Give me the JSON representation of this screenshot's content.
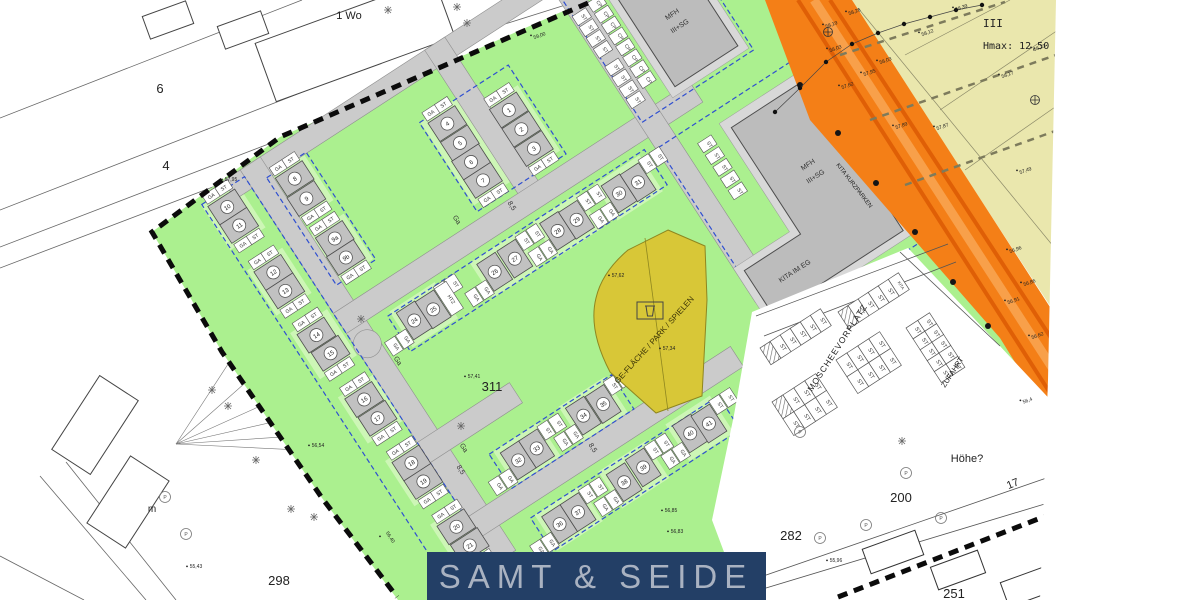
{
  "banner": {
    "title": "SAMT & SEIDE"
  },
  "zone": {
    "storeys": "III",
    "hmax": "Hmax: 12,50"
  },
  "labels": {
    "wo": "1 Wo",
    "m": "m",
    "hoehe": "Höhe?",
    "mfh": "MFH",
    "mfh_storeys": "III+SG",
    "kita_eg": "KITA IM EG",
    "kita_kurzparken": "KITA KURZPARKEN",
    "moscheevorplatz": "MOSCHEEVORPLATZ",
    "zufahrt": "ZUFAHRT",
    "ge_flaeche": "GE-FLÄCHE / PARK / SPIELEN",
    "tree_label": "P"
  },
  "parcels": {
    "p6": "6",
    "p4": "4",
    "p298": "298",
    "p311": "311",
    "p282": "282",
    "p200": "200",
    "p17": "17",
    "p251": "251"
  },
  "colors": {
    "green": "#abf08f",
    "pad": "#cdf6b6",
    "road": "#cbcbcb",
    "roadEdge": "#8f8f8f",
    "building": "#c1c1c1",
    "buildingEdge": "#4d4d4d",
    "beige": "#eae7ad",
    "orange": "#f47f17",
    "orangeDark": "#df5f06",
    "orangeLight": "#f8a04a",
    "yellow": "#d8c737",
    "yellowEdge": "#8e861f",
    "blue": "#2f4fd0",
    "navy": "#233f66",
    "bannerText": "#a9b2c1",
    "boundary": "#0b0b0b"
  },
  "estate": {
    "origin": [
      420,
      300
    ],
    "rotation": -33,
    "cell_labels": {
      "ga": "GA",
      "st": "ST",
      "cp": "CP",
      "htz": "HTZ"
    },
    "streets": [
      [
        -100,
        -207,
        280,
        -185
      ],
      [
        -80,
        -207,
        -56,
        262
      ],
      [
        140,
        -207,
        164,
        -22
      ],
      [
        -80,
        -36,
        345,
        -12
      ],
      [
        -80,
        118,
        30,
        142
      ],
      [
        -80,
        208,
        235,
        232
      ],
      [
        280,
        -207,
        304,
        185
      ]
    ],
    "junction": [
      -68,
      8,
      14
    ],
    "envelopes": [
      [
        -131,
        -199,
        -80,
        252
      ],
      [
        -62,
        -186,
        -15,
        -58
      ],
      [
        96,
        -149,
        202,
        -43
      ],
      [
        -36,
        -4,
        270,
        38
      ],
      [
        -26,
        167,
        120,
        208
      ],
      [
        -26,
        243,
        198,
        283
      ],
      [
        283,
        -175,
        416,
        -28
      ],
      [
        283,
        2,
        458,
        224
      ]
    ],
    "clusters": [
      {
        "dir": "col",
        "houses": [
          {
            "n": "1",
            "u": 178,
            "v": -111
          },
          {
            "n": "2",
            "u": 178,
            "v": -88
          },
          {
            "n": "3",
            "u": 178,
            "v": -65
          }
        ]
      },
      {
        "dir": "col",
        "houses": [
          {
            "n": "4",
            "u": 119,
            "v": -133
          },
          {
            "n": "5",
            "u": 119,
            "v": -110
          },
          {
            "n": "6",
            "u": 118,
            "v": -88
          },
          {
            "n": "7",
            "u": 118,
            "v": -66
          }
        ]
      },
      {
        "dir": "col",
        "houses": [
          {
            "n": "8",
            "u": -39,
            "v": -170
          },
          {
            "n": "9",
            "u": -40,
            "v": -147
          }
        ]
      },
      {
        "dir": "col",
        "houses": [
          {
            "n": "9a",
            "u": -38,
            "v": -98
          },
          {
            "n": "9b",
            "u": -39,
            "v": -76
          }
        ]
      },
      {
        "dir": "col",
        "houses": [
          {
            "n": "10",
            "u": -111,
            "v": -183
          },
          {
            "n": "11",
            "u": -111,
            "v": -161
          }
        ]
      },
      {
        "dir": "col",
        "houses": [
          {
            "n": "12",
            "u": -108,
            "v": -103
          },
          {
            "n": "13",
            "u": -108,
            "v": -81
          }
        ]
      },
      {
        "dir": "col",
        "houses": [
          {
            "n": "14",
            "u": -106,
            "v": -27
          },
          {
            "n": "15",
            "u": -104,
            "v": -4
          }
        ]
      },
      {
        "dir": "col",
        "houses": [
          {
            "n": "16",
            "u": -101,
            "v": 53
          },
          {
            "n": "17",
            "u": -100,
            "v": 76
          }
        ]
      },
      {
        "dir": "col",
        "houses": [
          {
            "n": "18",
            "u": -96,
            "v": 132
          },
          {
            "n": "19",
            "u": -96,
            "v": 154
          }
        ]
      },
      {
        "dir": "col",
        "houses": [
          {
            "n": "20",
            "u": -93,
            "v": 210
          },
          {
            "n": "21",
            "u": -92,
            "v": 233
          }
        ]
      },
      {
        "dir": "row",
        "extra": true,
        "houses": [
          {
            "n": "24",
            "u": -16,
            "v": 14
          },
          {
            "n": "25",
            "u": 6,
            "v": 15
          }
        ]
      },
      {
        "dir": "row",
        "houses": [
          {
            "n": "26",
            "u": 78,
            "v": 17
          },
          {
            "n": "27",
            "u": 102,
            "v": 17
          }
        ]
      },
      {
        "dir": "row",
        "houses": [
          {
            "n": "28",
            "u": 153,
            "v": 17
          },
          {
            "n": "29",
            "u": 175,
            "v": 18
          }
        ]
      },
      {
        "dir": "row",
        "houses": [
          {
            "n": "30",
            "u": 225,
            "v": 19
          },
          {
            "n": "31",
            "u": 247,
            "v": 20
          }
        ]
      },
      {
        "dir": "row",
        "houses": [
          {
            "n": "32",
            "u": -5,
            "v": 188
          },
          {
            "n": "33",
            "u": 17,
            "v": 188
          }
        ]
      },
      {
        "dir": "row",
        "houses": [
          {
            "n": "34",
            "u": 74,
            "v": 186
          },
          {
            "n": "35",
            "u": 97,
            "v": 187
          }
        ]
      },
      {
        "dir": "row",
        "houses": [
          {
            "n": "36",
            "u": -5,
            "v": 264
          },
          {
            "n": "37",
            "u": 17,
            "v": 264
          }
        ]
      },
      {
        "dir": "row",
        "houses": [
          {
            "n": "38",
            "u": 72,
            "v": 264
          },
          {
            "n": "39",
            "u": 96,
            "v": 262
          }
        ]
      },
      {
        "dir": "row",
        "houses": [
          {
            "n": "40",
            "u": 154,
            "v": 259
          },
          {
            "n": "41",
            "u": 175,
            "v": 261
          }
        ]
      }
    ],
    "strips": [
      {
        "t": "st",
        "u": 290,
        "v0": -155,
        "n": 4,
        "step": 13
      },
      {
        "t": "cp",
        "u": 310,
        "v0": -158,
        "n": 8,
        "step": 13
      },
      {
        "t": "st",
        "u": 290,
        "v0": -95,
        "n": 4,
        "step": 13
      },
      {
        "t": "st",
        "u": 326,
        "v0": 20,
        "n": 5,
        "step": 14
      }
    ],
    "mfh1_rect": [
      330,
      -160,
      405,
      -40
    ],
    "mfh1_apron": [
      322,
      -168,
      413,
      -32
    ],
    "l_apron": "347,15 451,15 451,213 280,213 280,144 347,144",
    "l_building": "355,25 443,25 443,205 288,205 288,152 355,152"
  },
  "left": {
    "lines": [
      [
        0,
        118,
        302,
        0
      ],
      [
        0,
        210,
        436,
        40
      ],
      [
        0,
        247,
        404,
        92
      ],
      [
        0,
        268,
        352,
        134
      ],
      [
        40,
        476,
        146,
        600
      ],
      [
        66,
        462,
        176,
        600
      ],
      [
        0,
        556,
        84,
        600
      ],
      [
        470,
        35,
        575,
        2
      ]
    ],
    "fan": {
      "cx": 176,
      "cy": 444,
      "ends": [
        [
          318,
          380
        ],
        [
          352,
          404
        ],
        [
          388,
          430
        ],
        [
          424,
          456
        ],
        [
          296,
          338
        ],
        [
          262,
          312
        ]
      ]
    },
    "polys": [
      {
        "x": 355,
        "y": 40,
        "w": 190,
        "h": 62,
        "r": -20
      },
      {
        "x": 168,
        "y": 20,
        "w": 46,
        "h": 24,
        "r": -20
      },
      {
        "x": 243,
        "y": 30,
        "w": 46,
        "h": 24,
        "r": -20
      },
      {
        "x": 95,
        "y": 425,
        "w": 88,
        "h": 46,
        "r": -57
      },
      {
        "x": 128,
        "y": 502,
        "w": 80,
        "h": 46,
        "r": -57
      }
    ]
  },
  "beige": {
    "lines": [
      [
        858,
        8,
        1058,
        252
      ],
      [
        905,
        55,
        1010,
        0
      ],
      [
        940,
        110,
        1058,
        30
      ],
      [
        965,
        170,
        1058,
        105
      ]
    ],
    "dash_lines": [
      [
        840,
        55,
        1005,
        2
      ],
      [
        870,
        120,
        1056,
        55
      ],
      [
        905,
        185,
        1058,
        130
      ]
    ],
    "dots": [
      [
        775,
        112
      ],
      [
        800,
        88
      ],
      [
        826,
        62
      ],
      [
        852,
        44
      ],
      [
        878,
        33
      ],
      [
        904,
        24
      ],
      [
        930,
        17
      ],
      [
        956,
        10
      ],
      [
        982,
        5
      ]
    ],
    "symbols": [
      [
        828,
        32
      ],
      [
        1035,
        100
      ]
    ]
  },
  "orange_dots": [
    [
      800,
      85
    ],
    [
      838,
      133
    ],
    [
      876,
      183
    ],
    [
      915,
      232
    ],
    [
      953,
      282
    ],
    [
      988,
      326
    ]
  ],
  "parking": [
    {
      "x": 838,
      "y": 312,
      "rot": -33,
      "cols": 6,
      "rows": 1,
      "cw": 12,
      "ch": 20,
      "labels": [
        "H",
        "ST",
        "ST",
        "ST",
        "ST",
        "KITA"
      ]
    },
    {
      "x": 760,
      "y": 348,
      "rot": -33,
      "cols": 6,
      "rows": 1,
      "cw": 12,
      "ch": 20,
      "labels": [
        "H",
        "ST",
        "ST",
        "ST",
        "ST",
        "ST"
      ]
    },
    {
      "x": 836,
      "y": 360,
      "rot": -33,
      "cols": 4,
      "rows": 2,
      "cw": 13,
      "ch": 20,
      "labels": [
        "ST",
        "ST",
        "ST",
        "ST",
        "ST",
        "ST",
        "ST",
        "ST"
      ]
    },
    {
      "x": 772,
      "y": 402,
      "rot": -33,
      "cols": 4,
      "rows": 2,
      "cw": 13,
      "ch": 20,
      "labels": [
        "H",
        "ST",
        "ST",
        "ST",
        "ST",
        "ST",
        "ST",
        "ST"
      ]
    },
    {
      "x": 906,
      "y": 328,
      "rot": -33,
      "cols": 2,
      "rows": 5,
      "cw": 14,
      "ch": 13,
      "labels": [
        "ST",
        "ST",
        "ST",
        "ST",
        "ST",
        "ST",
        "ST",
        "ST",
        "ST",
        "ST"
      ]
    }
  ],
  "moschee_lines": [
    [
      756,
      316,
      948,
      244
    ],
    [
      764,
      336,
      956,
      262
    ],
    [
      900,
      252,
      1000,
      346
    ],
    [
      694,
      600,
      1058,
      474
    ],
    [
      726,
      600,
      1058,
      500
    ]
  ],
  "bottom_houses": [
    {
      "x": 893,
      "y": 552,
      "w": 56,
      "h": 26,
      "r": -20
    },
    {
      "x": 958,
      "y": 570,
      "w": 50,
      "h": 24,
      "r": -20
    },
    {
      "x": 1032,
      "y": 585,
      "w": 58,
      "h": 26,
      "r": -20
    }
  ],
  "street_labels": [
    {
      "t": "Ga",
      "x": 396,
      "y": 362,
      "r": 57
    },
    {
      "t": "8,5",
      "x": 459,
      "y": 471,
      "r": 57
    },
    {
      "t": "Ga",
      "x": 462,
      "y": 449,
      "r": 57
    },
    {
      "t": "8,5",
      "x": 510,
      "y": 207,
      "r": 57
    },
    {
      "t": "Ga",
      "x": 455,
      "y": 221,
      "r": 57
    },
    {
      "t": "8,5",
      "x": 591,
      "y": 449,
      "r": 57
    }
  ],
  "elevations": [
    {
      "t": "58,39",
      "x": 962,
      "y": 9,
      "r": -20
    },
    {
      "t": "58,26",
      "x": 855,
      "y": 13,
      "r": -20
    },
    {
      "t": "58,19",
      "x": 832,
      "y": 26,
      "r": -20
    },
    {
      "t": "58,12",
      "x": 928,
      "y": 34,
      "r": -20
    },
    {
      "t": "58,03",
      "x": 886,
      "y": 62,
      "r": -20
    },
    {
      "t": "57,95",
      "x": 870,
      "y": 74,
      "r": -20
    },
    {
      "t": "57,62",
      "x": 848,
      "y": 87,
      "r": -20
    },
    {
      "t": "57,89",
      "x": 902,
      "y": 127,
      "r": -20
    },
    {
      "t": "57,87",
      "x": 943,
      "y": 128,
      "r": -20
    },
    {
      "t": "58,23",
      "x": 1040,
      "y": 49,
      "r": -20
    },
    {
      "t": "58,17",
      "x": 1008,
      "y": 76,
      "r": -20
    },
    {
      "t": "57,49",
      "x": 1026,
      "y": 172,
      "r": -20
    },
    {
      "t": "56,96",
      "x": 1016,
      "y": 251,
      "r": -20
    },
    {
      "t": "56,86",
      "x": 1030,
      "y": 284,
      "r": -20
    },
    {
      "t": "56,91",
      "x": 1014,
      "y": 302,
      "r": -20
    },
    {
      "t": "56,62",
      "x": 1038,
      "y": 337,
      "r": -20
    },
    {
      "t": "56,4",
      "x": 1028,
      "y": 402,
      "r": -20
    },
    {
      "t": "58,03",
      "x": 836,
      "y": 50,
      "r": -20
    },
    {
      "t": "59,00",
      "x": 540,
      "y": 37,
      "r": -20
    },
    {
      "t": "57,95",
      "x": 231,
      "y": 181,
      "r": 0
    },
    {
      "t": "56,54",
      "x": 318,
      "y": 447,
      "r": 0
    },
    {
      "t": "56,40",
      "x": 389,
      "y": 538,
      "r": 57
    },
    {
      "t": "57,41",
      "x": 474,
      "y": 378,
      "r": 0
    },
    {
      "t": "57,62",
      "x": 618,
      "y": 277,
      "r": 0
    },
    {
      "t": "57,34",
      "x": 669,
      "y": 350,
      "r": 0
    },
    {
      "t": "56,85",
      "x": 671,
      "y": 512,
      "r": 0
    },
    {
      "t": "56,83",
      "x": 677,
      "y": 533,
      "r": 0
    },
    {
      "t": "55,96",
      "x": 836,
      "y": 562,
      "r": 0
    },
    {
      "t": "55,43",
      "x": 196,
      "y": 568,
      "r": 0
    }
  ],
  "stars": [
    [
      388,
      10
    ],
    [
      457,
      7
    ],
    [
      467,
      23
    ],
    [
      361,
      319
    ],
    [
      461,
      426
    ],
    [
      212,
      390
    ],
    [
      228,
      406
    ],
    [
      256,
      460
    ],
    [
      291,
      509
    ],
    [
      314,
      517
    ],
    [
      902,
      441
    ]
  ],
  "trees": [
    [
      165,
      497
    ],
    [
      186,
      534
    ],
    [
      820,
      538
    ],
    [
      866,
      525
    ],
    [
      906,
      473
    ],
    [
      941,
      518
    ],
    [
      800,
      432
    ]
  ]
}
